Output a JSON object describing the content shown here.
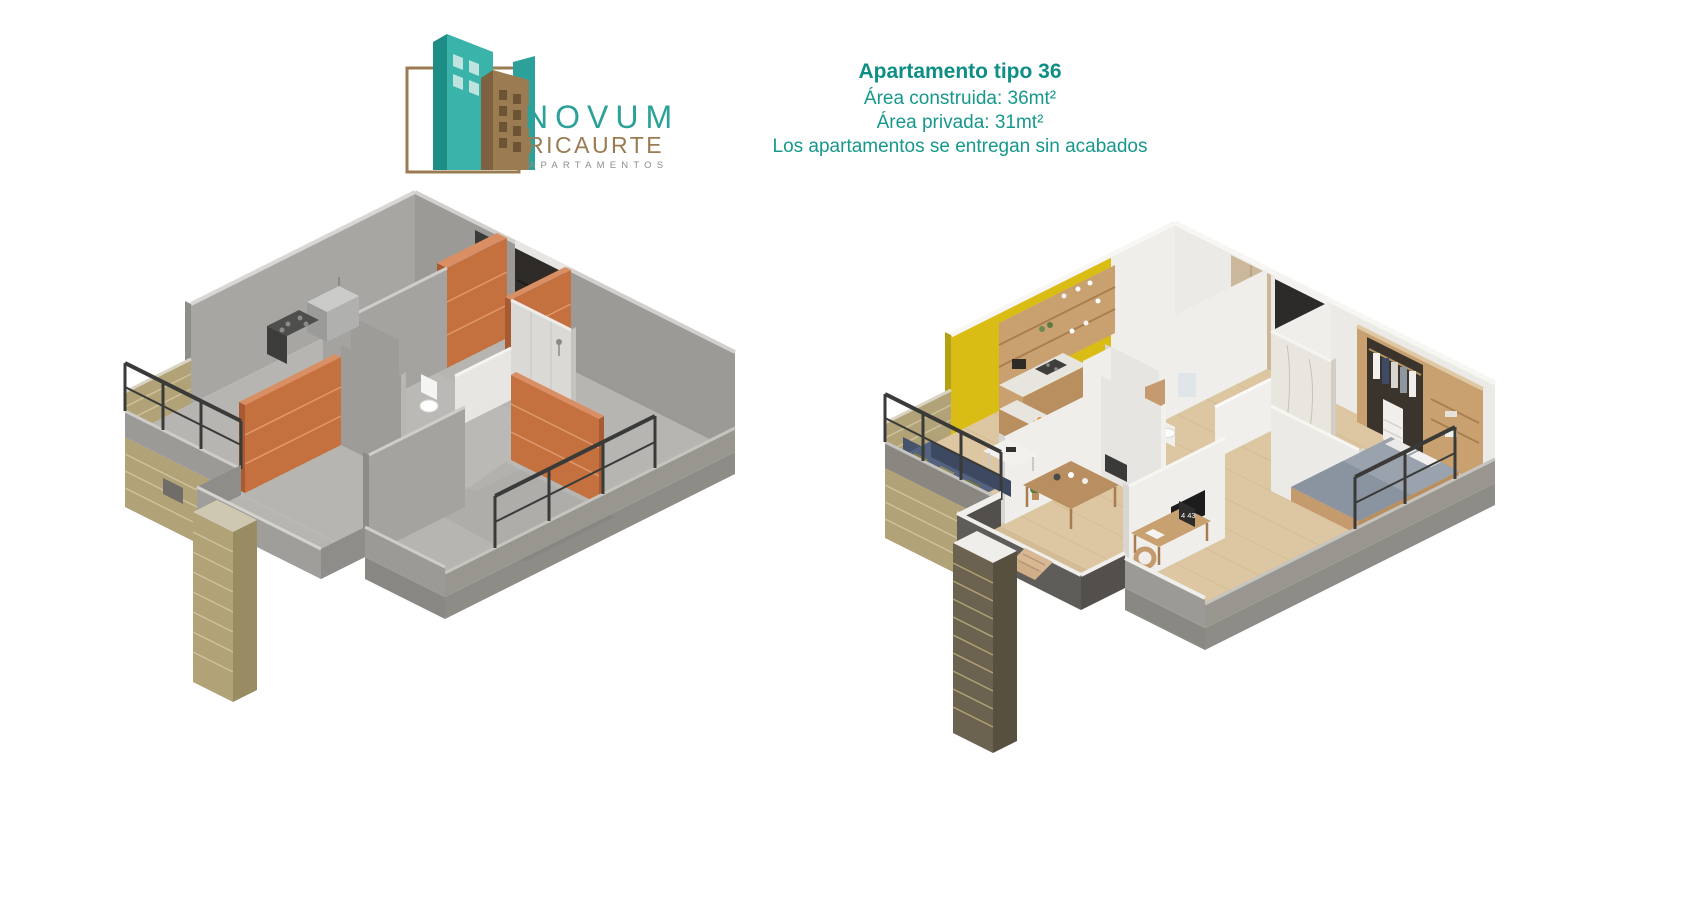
{
  "logo": {
    "brand": "NOVUM",
    "sub_brand": "RICAURTE",
    "tagline": "APARTAMENTOS",
    "colors": {
      "teal": "#2ba19a",
      "teal_dark": "#1e8d85",
      "teal_light": "#bfe4e0",
      "brown": "#9a7b52",
      "brown_dark": "#7d6140",
      "gray": "#8e8e8e"
    }
  },
  "header": {
    "title": "Apartamento tipo 36",
    "area_built": "Área construida: 36mt²",
    "area_private": "Área privada: 31mt²",
    "note": "Los apartamentos se entregan sin acabados",
    "text_color": "#16988c"
  },
  "floorplans": {
    "unfinished": {
      "label": "planta-obra-gris",
      "colors": {
        "concrete_floor": "#b7b5b1",
        "wall_light": "#a8a6a2",
        "wall_dark": "#9c9a96",
        "brick": "#c4713f",
        "brick_mortar": "#e09a6d",
        "tan_brick": "#b2a277",
        "railing": "#3a3a38",
        "door": "#2e2b28",
        "fixture_white": "#f4f4f2"
      }
    },
    "furnished": {
      "label": "planta-amoblada",
      "desk_clock": "4 43",
      "colors": {
        "wood_floor": "#dcc7a2",
        "wall_white": "#efeeea",
        "accent_yellow": "#d9bd15",
        "wood_furniture": "#c9a171",
        "marble": "#e8e4de",
        "sofa_navy": "#46536b",
        "pillow_olive": "#7d7c4f",
        "bed_gray": "#9aa2ad",
        "balcony_gray": "#5f5d59",
        "dark_brick": "#6b6250",
        "lounger_tan": "#d8b894"
      }
    }
  }
}
